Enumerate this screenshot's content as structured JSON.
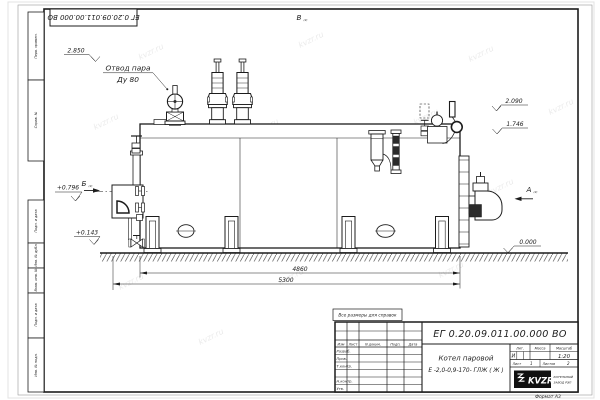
{
  "sheet": {
    "watermark": "kvzr.ru",
    "format_label": "Формат А3",
    "reference_note": "Все размеры для справок",
    "top_designation": "ЕГ 0.20.09.011.00.000  ВО",
    "margin_labels": [
      "Перв. примен.",
      "Справ. №",
      "Подп. и дата",
      "Инв. № дубл.",
      "Взам. инв. №",
      "Подп. и дата",
      "Инв. № подл."
    ]
  },
  "drawing": {
    "labels": {
      "steam_outlet_line1": "Отвод пара",
      "steam_outlet_line2": "Ду 80",
      "view_v": "В",
      "view_b": "Б",
      "view_a": "А",
      "view_sheet_ref": "(2)"
    },
    "elevations": {
      "top": "2.850",
      "rear_upper": "2.090",
      "rear_lower": "1.746",
      "front_mid": "+0.796",
      "front_low": "+0.143",
      "ground": "0.000"
    },
    "dimensions": {
      "boiler_length": "4860",
      "overall_length": "5300"
    }
  },
  "title_block": {
    "designation": "ЕГ 0.20.09.011.00.000  ВО",
    "product_line1": "Котел паровой",
    "product_line2": "Е -2,0-0,9-170- ГЛЖ ( Ж )",
    "columns": {
      "izm": "Изм",
      "list": "Лист",
      "doc": "N докум.",
      "sign": "Подп.",
      "date": "Дата"
    },
    "rows": {
      "developed": "Разраб.",
      "checked": "Пров.",
      "tcontrol": "Т.контр.",
      "ncontrol": "Н.контр.",
      "approved": "Утв."
    },
    "litera_label": "Лит.",
    "mass_label": "Масса",
    "scale_label": "Масштаб",
    "litera": "И",
    "scale": "1:20",
    "sheet_label": "Лист",
    "sheet_number": "1",
    "sheets_label": "Листов",
    "sheets_total": "2",
    "logo_text": "KVZR",
    "company_line1": "КОТЕЛЬНЫЙ",
    "company_line2": "ЗАВОД РЭП"
  }
}
